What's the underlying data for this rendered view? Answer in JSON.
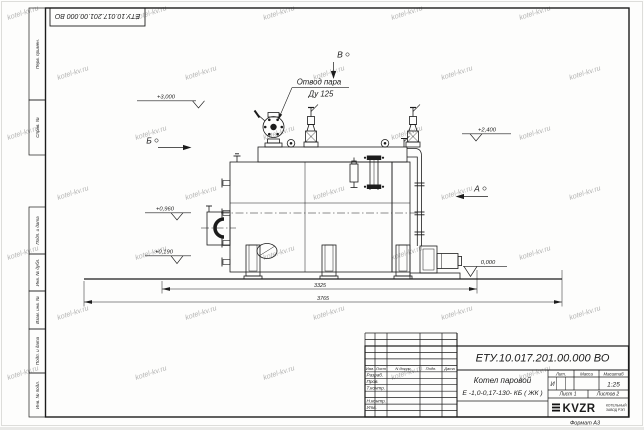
{
  "designation": "ЕТУ.10.017.201.00.000  ВО",
  "watermark": {
    "text": "kotel-kv.ru"
  },
  "page": {
    "format_label": "Формат А3"
  },
  "left_margin": {
    "cells": [
      "Перв. примен.",
      "Справ. №",
      "Подп. и дата",
      "Инв. № дубл.",
      "Взам. инв. №",
      "Подп. и дата",
      "Инв. № подл."
    ]
  },
  "title_block": {
    "header_cols": [
      "Изм.",
      "Лист",
      "N докум.",
      "Подп.",
      "Дата"
    ],
    "sign_rows": [
      "Разраб.",
      "Пров.",
      "Т.контр.",
      "Н.контр.",
      "Утв."
    ],
    "doc_title_line1": "Котел паровой",
    "doc_title_line2": "Е -1,0-0,17-130- КБ ( ЖК )",
    "lit_label": "Лит.",
    "mass_label": "Масса",
    "scale_label": "Масштаб",
    "lit_value": "И",
    "scale_value": "1:25",
    "sheet_info": "Лист 1",
    "sheets_info": "Листов 2",
    "company_logo": "KVZR",
    "company_sub1": "КОТЕЛЬНЫЙ",
    "company_sub2": "ЗАВОД РЭП"
  },
  "drawing": {
    "labels": {
      "steam_outlet_1": "Отвод пара",
      "steam_outlet_2": "Ду 125",
      "view_b": "Б",
      "view_a": "А",
      "view_v": "В",
      "elev_top": "+3,000",
      "elev_drum": "+2,400",
      "elev_burner": "+0,960",
      "elev_low": "+0,190",
      "elev_zero": "0,000",
      "dim_inner": "3325",
      "dim_outer": "3765"
    }
  }
}
